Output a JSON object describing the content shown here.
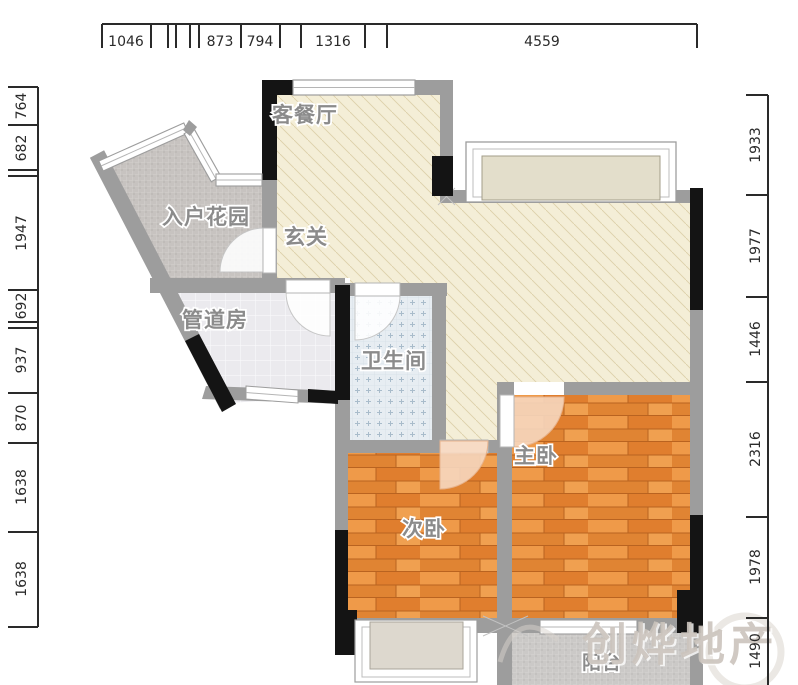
{
  "rooms": {
    "living": "客餐厅",
    "garden": "入户花园",
    "foyer": "玄关",
    "pipe": "管道房",
    "bath": "卫生间",
    "second_bedroom": "次卧",
    "master_bedroom": "主卧",
    "balcony": "阳台"
  },
  "watermark": "创烨地产",
  "dimensions": {
    "top": [
      "1046",
      "873",
      "794",
      "1316",
      "4559"
    ],
    "left": [
      "764",
      "682",
      "1947",
      "692",
      "937",
      "870",
      "1638",
      "1638"
    ],
    "right": [
      "1933",
      "1977",
      "1446",
      "2316",
      "1978",
      "1490"
    ]
  },
  "colors": {
    "wall_gray": "#9d9d9d",
    "wall_black": "#141414",
    "living_floor": "#f4eed7",
    "wood_floor": "#e6873b",
    "bath_tile": "#e7edf2",
    "garden_tile": "#c7c3c0",
    "dimension_line": "#2a2a2a"
  }
}
